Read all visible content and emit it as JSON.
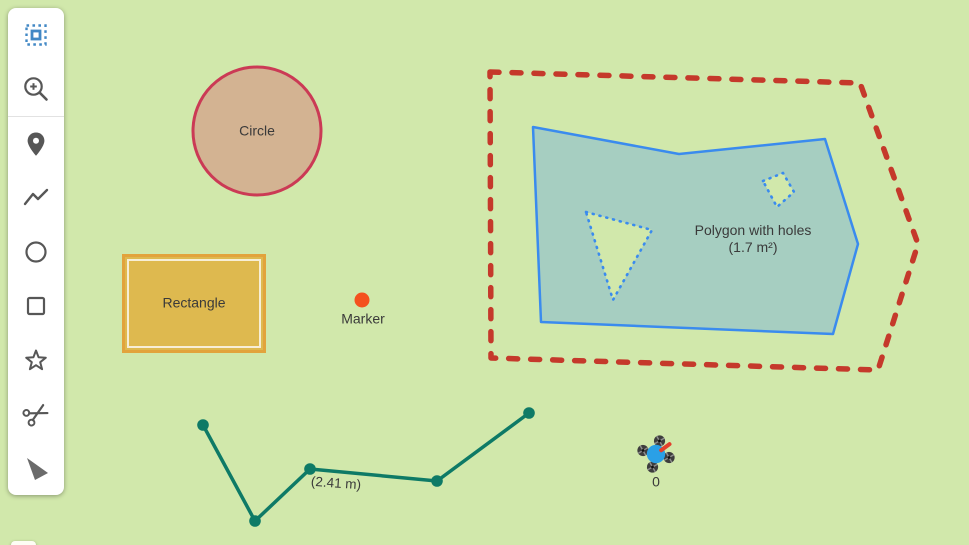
{
  "map": {
    "background_color": "#d1e8ab"
  },
  "toolbar": {
    "items": [
      {
        "icon": "transform-selection-icon",
        "active": true,
        "color": "#4288c5"
      },
      {
        "icon": "zoom-in-icon",
        "active": false,
        "color": "#575757"
      },
      {
        "icon": "marker-tool-icon",
        "active": false,
        "color": "#575757"
      },
      {
        "icon": "polyline-tool-icon",
        "active": false,
        "color": "#575757"
      },
      {
        "icon": "circle-tool-icon",
        "active": false,
        "color": "#575757"
      },
      {
        "icon": "rectangle-tool-icon",
        "active": false,
        "color": "#575757"
      },
      {
        "icon": "star-polygon-tool-icon",
        "active": false,
        "color": "#575757"
      },
      {
        "icon": "cut-tool-icon",
        "active": false,
        "color": "#575757"
      },
      {
        "icon": "drag-cursor-tool-icon",
        "active": false,
        "color": "#6b6b6b"
      }
    ]
  },
  "shapes": {
    "circle": {
      "label": "Circle",
      "stroke": "#cb3a55",
      "fill": "#d3b392"
    },
    "rectangle": {
      "label": "Rectangle",
      "stroke": "#e2a33c",
      "fill": "#deb94f"
    },
    "marker": {
      "label": "Marker",
      "color": "#f4511e"
    },
    "polygon_with_holes": {
      "label": "Polygon with holes",
      "area_label": "(1.7 m²)",
      "stroke": "#3a8bee",
      "fill": "#3388ff"
    },
    "selection_outline": {
      "color": "#c5392b",
      "style": "dashed"
    },
    "polyline": {
      "label": "(2.41 m)",
      "color": "#0e7a66"
    },
    "drone": {
      "label": "0",
      "body_color": "#2aa0e6",
      "heading_color": "#e2402c"
    }
  }
}
